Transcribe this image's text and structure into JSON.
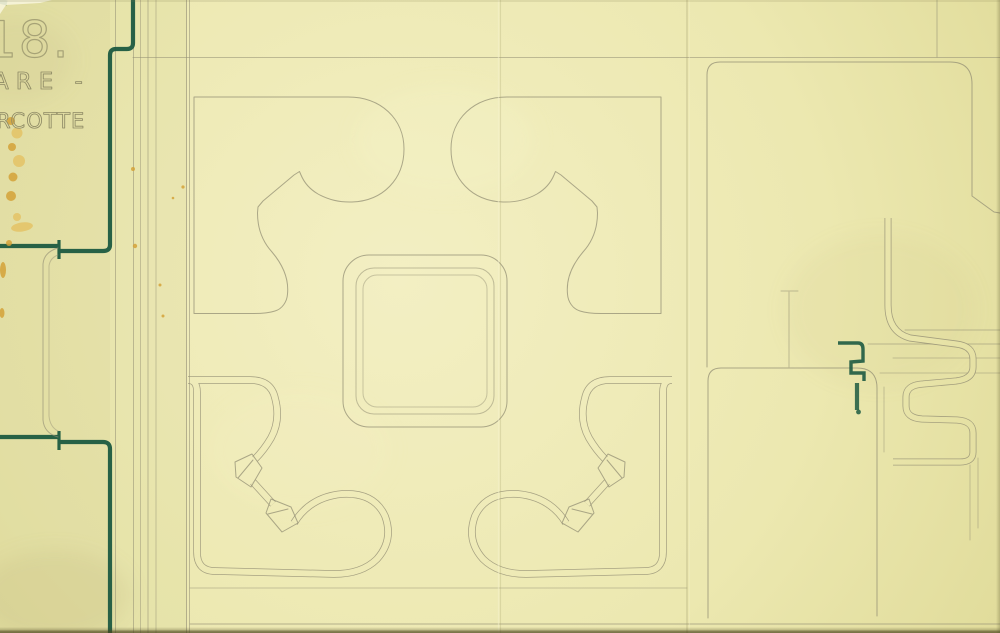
{
  "annotations": {
    "plate_number": "18.",
    "caption_line1": "ARE -",
    "caption_line2": "RCOTTE"
  },
  "colors": {
    "paper_light": "#f3efc3",
    "paper_mid": "#eae6ac",
    "paper_dark": "#ddd894",
    "pencil": "#938f74",
    "pencil_dark": "#7e7a5e",
    "ink": "#1d5a41",
    "stain": "#d4a238",
    "stain_light": "#e3c161"
  }
}
